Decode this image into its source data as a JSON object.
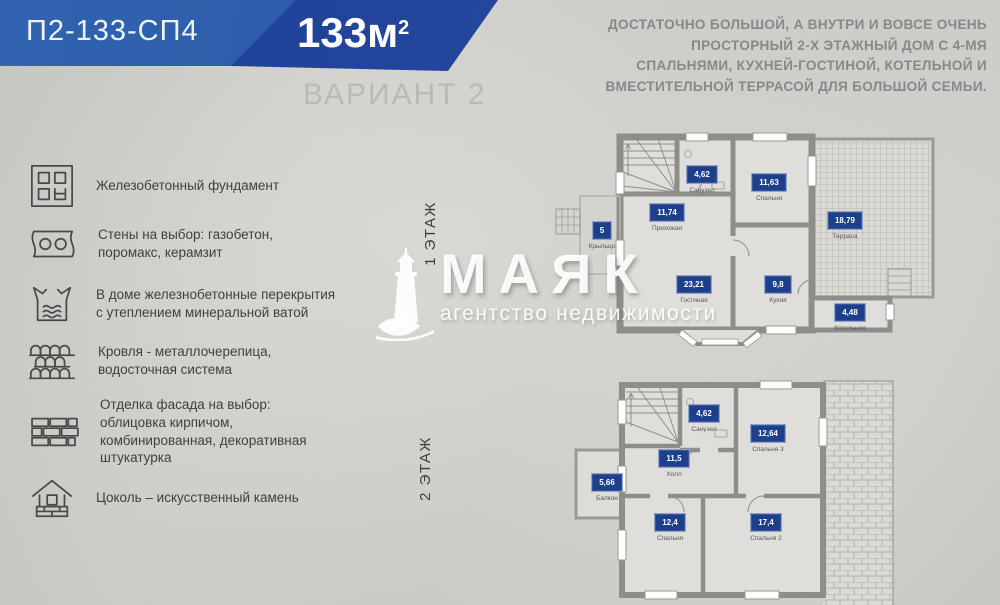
{
  "header": {
    "plan_code": "П2-133-СП4",
    "area_value": "133м",
    "area_sup": "2",
    "variant_label": "ВАРИАНТ 2"
  },
  "description": "ДОСТАТОЧНО БОЛЬШОЙ, А ВНУТРИ И ВОВСЕ ОЧЕНЬ\nПРОСТОРНЫЙ 2-Х ЭТАЖНЫЙ ДОМ С 4-МЯ\nСПАЛЬНЯМИ, КУХНЕЙ-ГОСТИНОЙ, КОТЕЛЬНОЙ И\nВМЕСТИТЕЛЬНОЙ ТЕРРАСОЙ ДЛЯ БОЛЬШОЙ СЕМЬИ.",
  "features": [
    {
      "icon": "foundation-icon",
      "text": "Железобетонный фундамент"
    },
    {
      "icon": "wall-blocks-icon",
      "text": "Стены на выбор: газобетон,\nпоромакс, керамзит"
    },
    {
      "icon": "floor-slab-icon",
      "text": "В доме железнобетонные перекрытия\nс утеплением минеральной ватой"
    },
    {
      "icon": "roof-tiles-icon",
      "text": "Кровля - металлочерепица,\nводосточная система"
    },
    {
      "icon": "brick-facade-icon",
      "text": "Отделка фасада на выбор:\nоблицовка кирпичом,\nкомбинированная, декоративная\nштукатурка"
    },
    {
      "icon": "plinth-house-icon",
      "text": "Цоколь – искусственный камень"
    }
  ],
  "watermark": {
    "brand": "МАЯК",
    "tagline": "агентство недвижимости"
  },
  "floors": [
    {
      "label": "1 ЭТАЖ",
      "rooms": [
        {
          "area": "5",
          "name": "Крыльцо"
        },
        {
          "area": "11,74",
          "name": "Прихожая"
        },
        {
          "area": "4,62",
          "name": "Санузел"
        },
        {
          "area": "11,63",
          "name": "Спальня"
        },
        {
          "area": "18,79",
          "name": "Терраса"
        },
        {
          "area": "23,21",
          "name": "Гостиная"
        },
        {
          "area": "9,8",
          "name": "Кухня"
        },
        {
          "area": "4,48",
          "name": "Котельная"
        }
      ]
    },
    {
      "label": "2 ЭТАЖ",
      "rooms": [
        {
          "area": "4,62",
          "name": "Санузел"
        },
        {
          "area": "12,64",
          "name": "Спальня 3"
        },
        {
          "area": "11,5",
          "name": "Холл"
        },
        {
          "area": "5,66",
          "name": "Балкон"
        },
        {
          "area": "12,4",
          "name": "Спальня"
        },
        {
          "area": "17,4",
          "name": "Спальня 2"
        }
      ]
    }
  ],
  "colors": {
    "banner_light": "#2c5fae",
    "banner_dark": "#1f3e95",
    "badge_navy": "#1e3f8a",
    "wall_grey": "#8e8e89"
  }
}
